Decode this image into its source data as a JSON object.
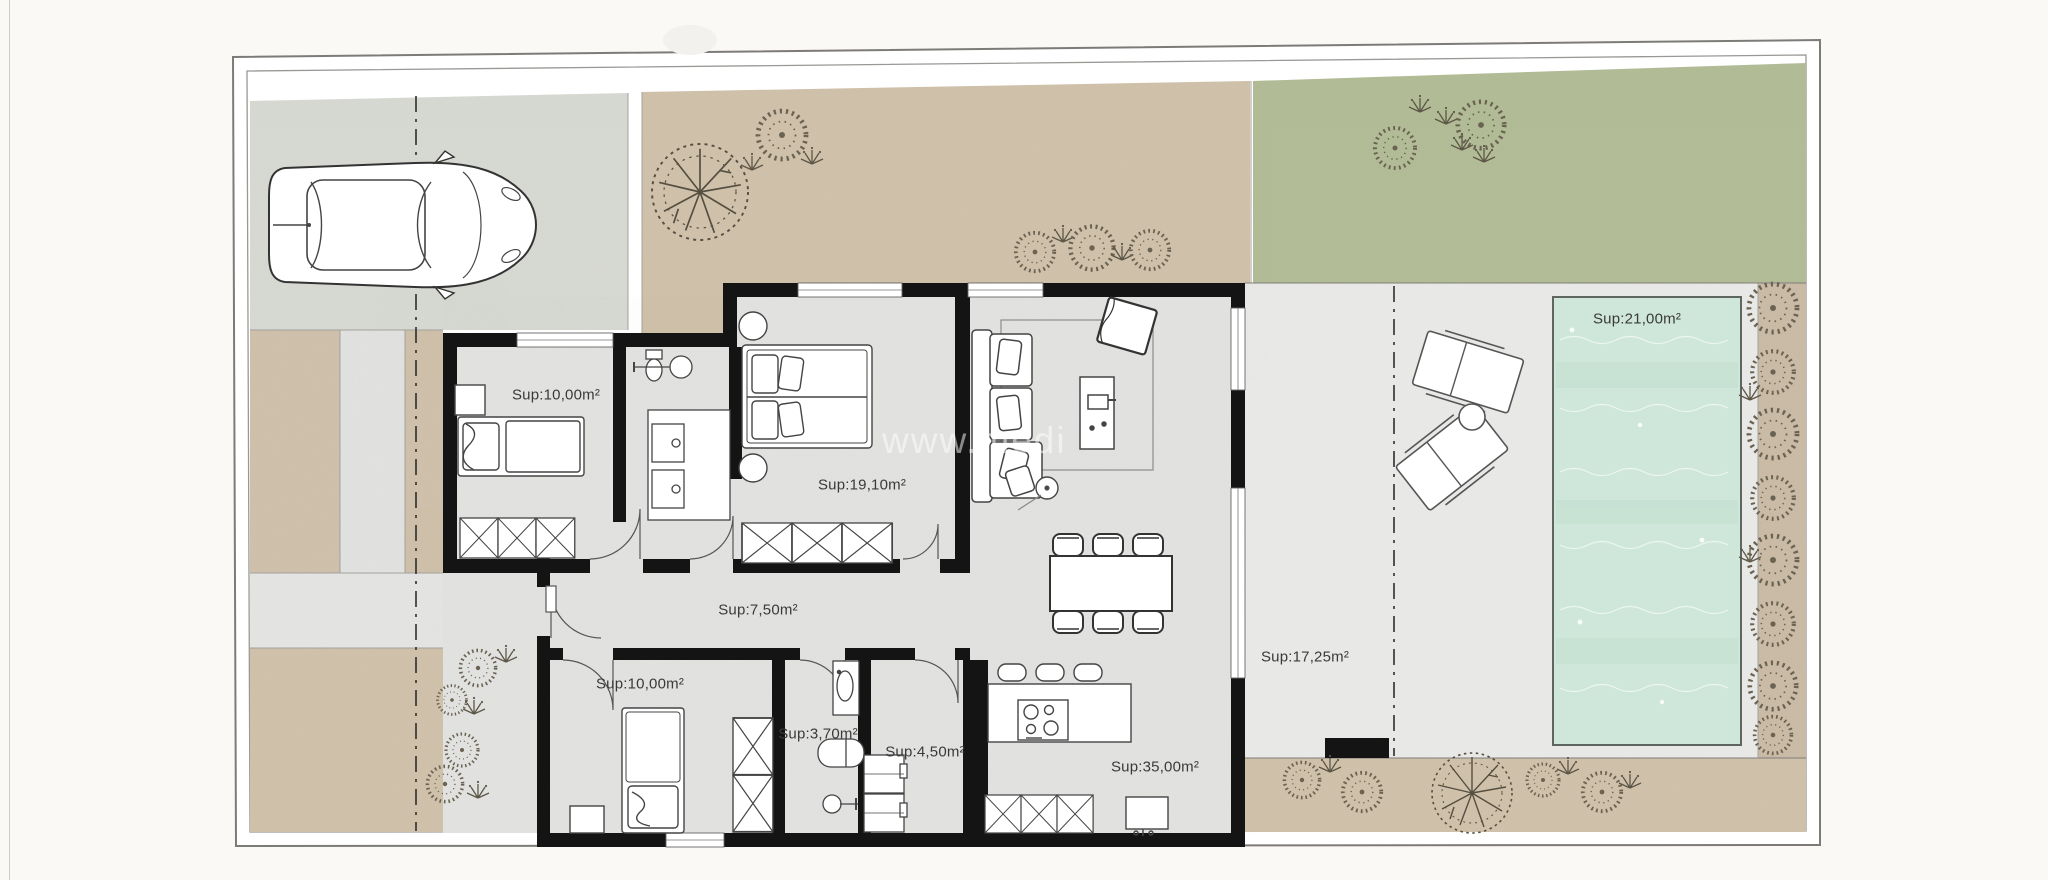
{
  "plan": {
    "watermark": "www.medi",
    "rooms": [
      {
        "name": "bedroom-top-left",
        "label": "Sup:10,00m²",
        "area_m2": 10.0
      },
      {
        "name": "master-bedroom",
        "label": "Sup:19,10m²",
        "area_m2": 19.1
      },
      {
        "name": "hallway",
        "label": "Sup:7,50m²",
        "area_m2": 7.5
      },
      {
        "name": "bedroom-bottom-left",
        "label": "Sup:10,00m²",
        "area_m2": 10.0
      },
      {
        "name": "bathroom-small",
        "label": "Sup:3,70m²",
        "area_m2": 3.7
      },
      {
        "name": "laundry",
        "label": "Sup:4,50m²",
        "area_m2": 4.5
      },
      {
        "name": "kitchen-living",
        "label": "Sup:35,00m²",
        "area_m2": 35.0
      },
      {
        "name": "terrace",
        "label": "Sup:17,25m²",
        "area_m2": 17.25
      },
      {
        "name": "pool",
        "label": "Sup:21,00m²",
        "area_m2": 21.0
      }
    ],
    "colors": {
      "page": "#fbf9f6",
      "driveway": "#d8dbd4",
      "sand": "#d1c2ab",
      "lawn": "#b2bd97",
      "house_floor": "#e2e3e1",
      "terrace_deck": "#ebecea",
      "pool_water": "#cfe7da",
      "wall": "#141414"
    }
  }
}
